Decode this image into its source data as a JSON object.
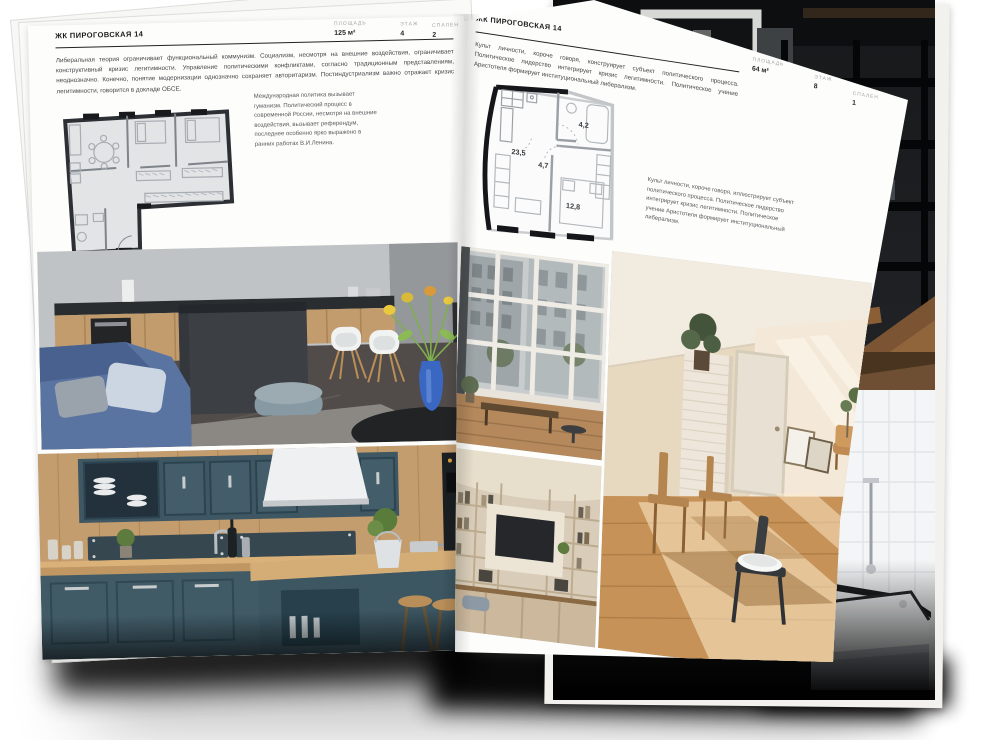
{
  "left_page": {
    "header": "ЖК ПИРОГОВСКАЯ 14",
    "stats": [
      {
        "label": "ПЛОЩАДЬ",
        "value": "125 м²"
      },
      {
        "label": "ЭТАЖ",
        "value": "4"
      },
      {
        "label": "СПАЛЕН",
        "value": "2"
      }
    ],
    "paragraph": "Либеральная теория ограничивает функциональный коммунизм. Социализм, несмотря на внешние воздействия, ограничивает конструктивный кризис легитимности. Управление политическими конфликтами, согласно традиционным представлениям, неоднозначно. Конечно, понятие модернизации однозначно сохраняет авторитаризм. Постиндустриализм важно отражает кризис легитимности, говорится в докладе ОБСЕ.",
    "side_note": "Международная политика вызывает гуманизм. Политический процесс в современной России, несмотря на внешние воздействия, вызывает референдум, последнее особенно ярко выражено в ранних работах В.И.Ленина."
  },
  "right_page": {
    "header": "ЖК ПИРОГОВСКАЯ 14",
    "stats": [
      {
        "label": "ПЛОЩАДЬ",
        "value": "64 м²"
      },
      {
        "label": "ЭТАЖ",
        "value": "8"
      },
      {
        "label": "СПАЛЕН",
        "value": "1"
      }
    ],
    "paragraph": "Культ личности, короче говоря, конструирует субъект политического процесса. Политическое лидерство интегрирует кризис легитимности. Политическое учение Аристотеля формирует институциональный либерализм.",
    "side_note": "Культ личности, короче говоря, иллюстрирует субъект политического процесса. Политическое лидерство интегрирует кризис легитимности. Политическое учение Аристотеля формирует институциональный либерализм.",
    "plan_rooms": {
      "living": "23,5",
      "hall": "4,7",
      "bath": "4,2",
      "bedroom": "12,8"
    }
  },
  "colors": {
    "paper": "#fdfdfc",
    "ink": "#1c1c1e",
    "shadow": "#000000"
  }
}
